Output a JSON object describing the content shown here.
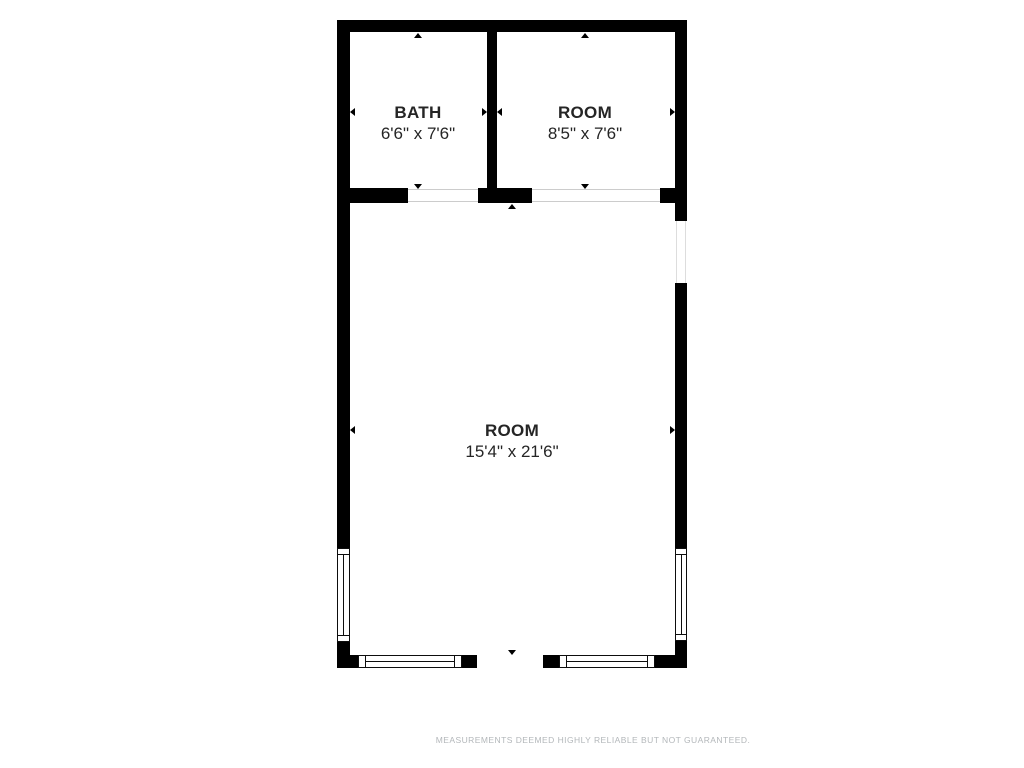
{
  "plan": {
    "rooms": [
      {
        "name": "BATH",
        "dimensions": "6'6\" x 7'6\""
      },
      {
        "name": "ROOM",
        "dimensions": "8'5\" x 7'6\""
      },
      {
        "name": "ROOM",
        "dimensions": "15'4\" x 21'6\""
      }
    ],
    "colors": {
      "wall": "#000000",
      "label_text": "#252525",
      "disclaimer_text": "#b3b7ba",
      "background": "#ffffff"
    }
  },
  "footer": {
    "disclaimer": "MEASUREMENTS DEEMED HIGHLY RELIABLE BUT NOT GUARANTEED."
  }
}
